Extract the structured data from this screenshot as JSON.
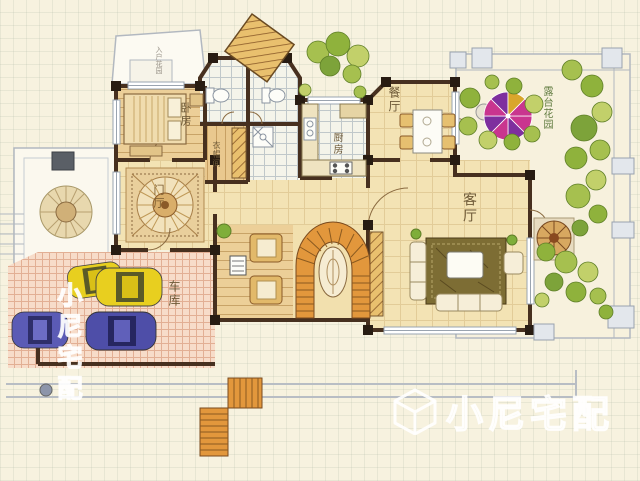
{
  "plan": {
    "rooms": {
      "bedroom": {
        "label": "卧房"
      },
      "cloakroom": {
        "label": "衣帽间"
      },
      "kitchen": {
        "label": "厨房"
      },
      "dining": {
        "label": "餐厅"
      },
      "living": {
        "label": "客厅"
      },
      "foyer": {
        "label": "门厅"
      },
      "garage": {
        "label": "车库"
      },
      "terrace_garden": {
        "label": "露台花园"
      },
      "entry_note": {
        "label": "入户花园"
      }
    }
  },
  "watermark": {
    "brand": "小尼宅配",
    "side": "小尼宅配",
    "logo": "cube-icon"
  },
  "colors": {
    "background": "#f7f2df",
    "wall": "#47301f",
    "floor_tan": "#f3e3b4",
    "floor_wood": "#eccf98",
    "floor_tile": "#f4f4ea",
    "garage_floor": "#f7dcc9",
    "stair_orange": "#e2973c",
    "tree_green": "#9ab84a",
    "umbrella_magenta": "#c9358f",
    "umbrella_purple": "#7e2f9e",
    "car_yellow": "#e8cf1f",
    "car_blue": "#5b5bb5",
    "watermark": "#ffffff"
  }
}
